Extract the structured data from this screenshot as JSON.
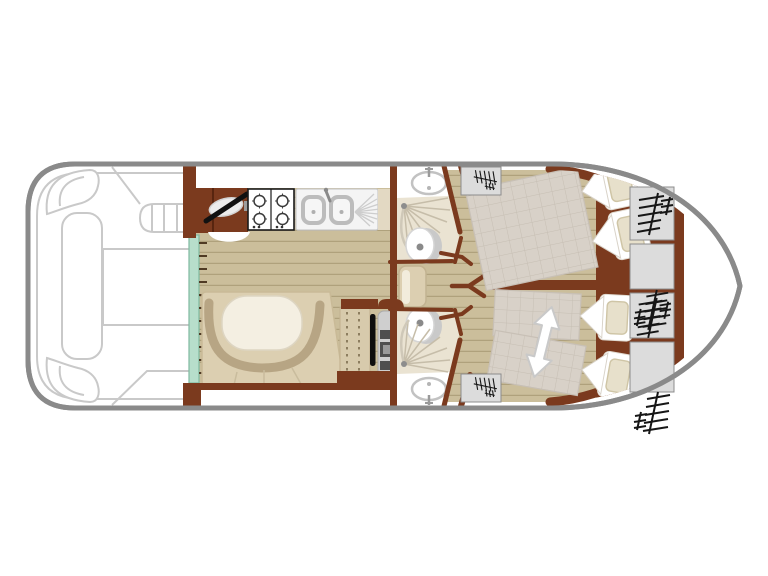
{
  "diagram": {
    "kind": "houseboat-floor-plan",
    "orientation": "bow-right-stern-left",
    "areas": {
      "bow_deck": {
        "features": [
          "corner-seat-port",
          "corner-seat-starboard",
          "long-bench",
          "deck-table",
          "deck-steps"
        ]
      },
      "galley": {
        "appliances": [
          "oven-icon",
          "hob-icon",
          "double-sink-icon",
          "drainer-icon"
        ],
        "burner_count": 4
      },
      "saloon": {
        "features": [
          "sliding-door",
          "u-dinette-bench",
          "oval-table",
          "plank-floor"
        ]
      },
      "helm_station": {
        "features": [
          "dashboard",
          "helm-bench",
          "steering-wheel-icon",
          "throttle-console"
        ]
      },
      "bathroom_fore": {
        "fixtures": [
          "washbasin-icon",
          "shower-icon",
          "toilet-icon"
        ]
      },
      "bathroom_aft": {
        "fixtures": [
          "toilet-icon",
          "shower-icon",
          "washbasin-icon"
        ]
      },
      "cabin_fore": {
        "beds": [
          "double-bed"
        ],
        "pillow_count": 2
      },
      "cabin_aft": {
        "beds": [
          "single-bed",
          "single-bed"
        ],
        "pillow_count": 2,
        "icons": [
          "convert-arrow-icon"
        ]
      },
      "stern": {
        "storage_units": 4,
        "hatch_icons": 6,
        "companionway_boxes": 2
      }
    },
    "colors": {
      "hull_outline": "#8A8A8A",
      "deck_outline": "#C9C9C9",
      "wall": "#7B3A1E",
      "wall_dark": "#58250F",
      "wood": "#CBBE9B",
      "wood_line": "#9C8E68",
      "door_glass": "#B7DECB",
      "door_glass_edge": "#7FB9A0",
      "bench": "#DCCFB1",
      "bench_edge": "#B7A584",
      "table": "#F4EFE2",
      "bath_floor": "#EAE3D2",
      "fixture": "#C2C2C2",
      "blanket": "#D8D1C8",
      "blanket_line": "#C6BEB3",
      "pillow": "#E7E0CB",
      "sheet": "#FFFFFF",
      "storage_box": "#DCDCDC",
      "icon": "#161616",
      "console": "#CFCFCF",
      "wheel": "#0E0E0E",
      "arrow_outline": "#C9C9C9"
    }
  }
}
